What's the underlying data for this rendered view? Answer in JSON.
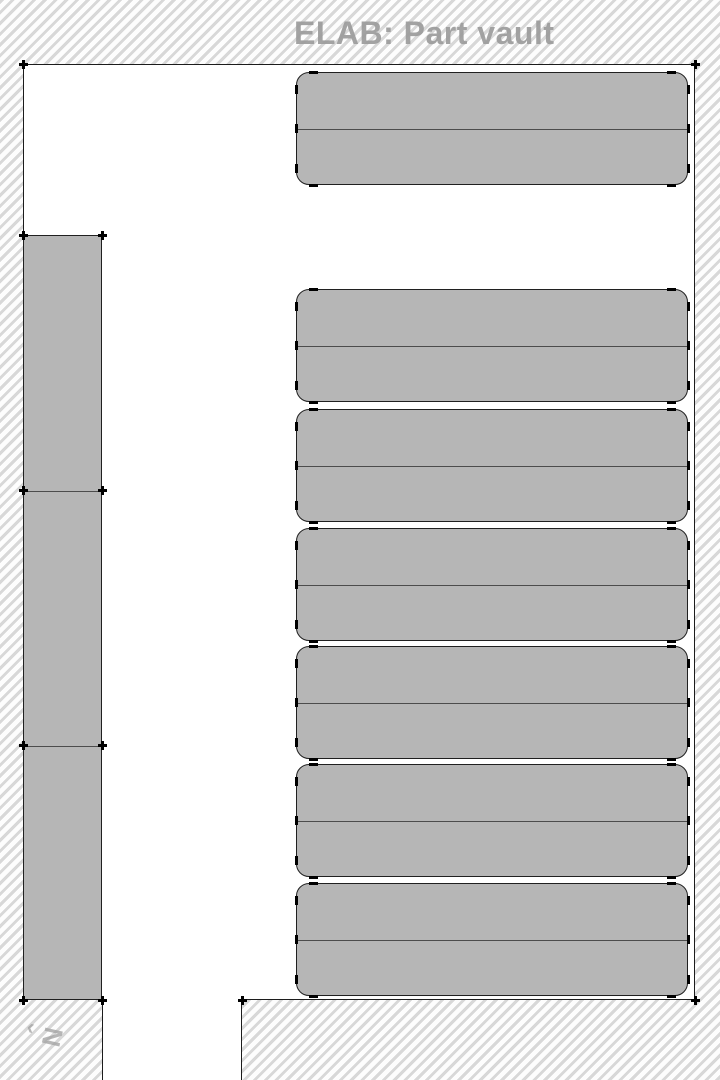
{
  "title": "ELAB: Part vault",
  "compass": {
    "chevron": "‹",
    "label": "N"
  },
  "colors": {
    "hatch_line": "#d8d8d8",
    "floor": "#ffffff",
    "wall": "#1c1c1c",
    "rack_fill": "#b6b6b6",
    "rack_border": "#202020",
    "shelf_divider": "#4c4c4c",
    "corner_tick": "#000000",
    "title_text": "#9c9c9c",
    "compass_text": "#a3a3a3"
  },
  "map": {
    "room": {
      "x": 23,
      "y": 64,
      "w": 672,
      "h": 936
    },
    "doorway": {
      "x": 102,
      "y": 998,
      "w": 140,
      "h": 82
    },
    "wall_rack_column": {
      "x": 23,
      "y": 235,
      "w": 79,
      "h": 765,
      "dividers": [
        255,
        510
      ],
      "sections": 3
    },
    "floor_racks": {
      "x": 296,
      "w": 392,
      "corner_radius": 13,
      "double_sided": true,
      "rows": [
        {
          "y": 72,
          "h": 113
        },
        {
          "y": 289,
          "h": 113
        },
        {
          "y": 409,
          "h": 113
        },
        {
          "y": 528,
          "h": 113
        },
        {
          "y": 646,
          "h": 113
        },
        {
          "y": 764,
          "h": 113
        },
        {
          "y": 883,
          "h": 113
        }
      ]
    },
    "room_corner_ticks": [
      {
        "x": 23,
        "y": 64
      },
      {
        "x": 695,
        "y": 64
      },
      {
        "x": 695,
        "y": 1000
      },
      {
        "x": 242,
        "y": 1000
      }
    ]
  }
}
